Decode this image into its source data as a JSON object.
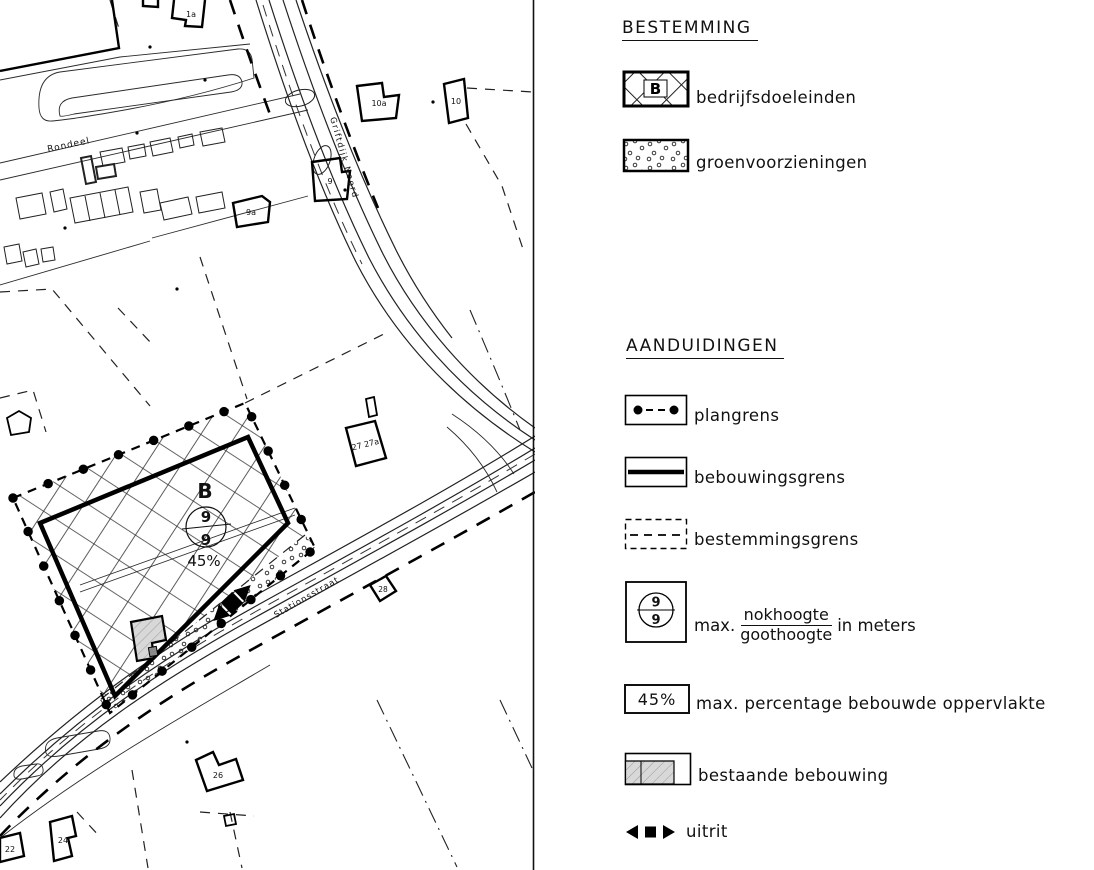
{
  "map": {
    "streets": {
      "rondeel": "Rondeel",
      "griftdijk": "Griftdijk Noord",
      "stationsstraat": "Stationsstraat"
    },
    "buildings": {
      "b1a": "1a",
      "b9a": "9a",
      "b9": "9",
      "b10a": "10a",
      "b10": "10",
      "b27": "27 27a",
      "b28": "28",
      "b26": "26",
      "b24": "24",
      "b22": "22"
    },
    "zone": {
      "letter": "B",
      "nokhoogte": "9",
      "goothoogte": "9",
      "percentage": "45%"
    }
  },
  "legend": {
    "bestemming": {
      "title": "BESTEMMING",
      "items": [
        {
          "symbol": "crosshatch-B",
          "letter": "B",
          "label": "bedrijfsdoeleinden"
        },
        {
          "symbol": "dotted-fill",
          "label": "groenvoorzieningen"
        }
      ]
    },
    "aanduidingen": {
      "title": "AANDUIDINGEN",
      "items": [
        {
          "symbol": "dot-dash-line",
          "label": "plangrens"
        },
        {
          "symbol": "thick-line",
          "label": "bebouwingsgrens"
        },
        {
          "symbol": "dashed-line",
          "label": "bestemmingsgrens"
        },
        {
          "symbol": "circle-fraction",
          "numerator": "9",
          "denominator": "9",
          "prefix": "max.",
          "fraction_top": "nokhoogte",
          "fraction_bottom": "goothoogte",
          "suffix": "in meters"
        },
        {
          "symbol": "percent-box",
          "value": "45%",
          "label": "max. percentage bebouwde oppervlakte"
        },
        {
          "symbol": "existing-building",
          "label": "bestaande bebouwing"
        },
        {
          "symbol": "arrows-square",
          "label": "uitrit"
        }
      ]
    },
    "ink_color": "#111111",
    "existing_building_gray": "#d8d8d8"
  }
}
